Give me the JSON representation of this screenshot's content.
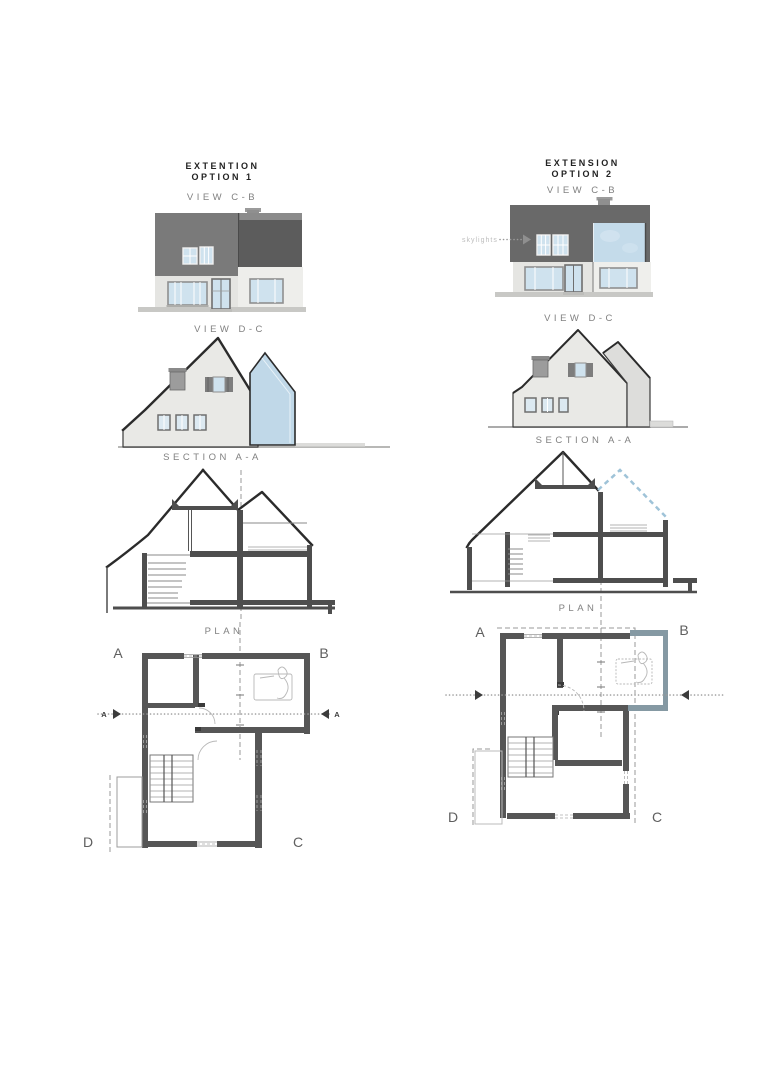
{
  "option1": {
    "title": {
      "line1": "EXTENTION",
      "line2": "OPTION 1"
    },
    "views": {
      "view_cb": "VIEW C-B",
      "view_dc": "VIEW D-C",
      "section": "SECTION A-A",
      "plan": "PLAN"
    },
    "plan_labels": {
      "corner_a": "A",
      "corner_b": "B",
      "corner_c": "C",
      "corner_d": "D",
      "section_marker_left": "A",
      "section_marker_right": "A"
    }
  },
  "option2": {
    "title": {
      "line1": "EXTENSION",
      "line2": "OPTION 2"
    },
    "views": {
      "view_cb": "VIEW C-B",
      "view_dc": "VIEW D-C",
      "section": "SECTION A-A",
      "plan": "PLAN"
    },
    "plan_labels": {
      "corner_a": "A",
      "corner_b": "B",
      "corner_c": "C",
      "corner_d": "D"
    },
    "annotations": {
      "skylights": "skylights"
    }
  },
  "colors": {
    "roof_medium": "#7a7a7a",
    "roof_dark": "#5c5c5c",
    "roof_option2": "#696969",
    "wall_light": "#e5e5e2",
    "wall_lighter": "#eeeeeb",
    "window_glass": "#cfe2ee",
    "glazing_blue": "#c4dbea",
    "extension_glazed_side": "#c0d8e8",
    "ground_gray": "#c8c8c5",
    "section_wall": "#4e4e4e",
    "plan_wall": "#565656",
    "plan_new_wall": "#8599a3",
    "title_text": "#222222",
    "label_text": "#818181"
  }
}
